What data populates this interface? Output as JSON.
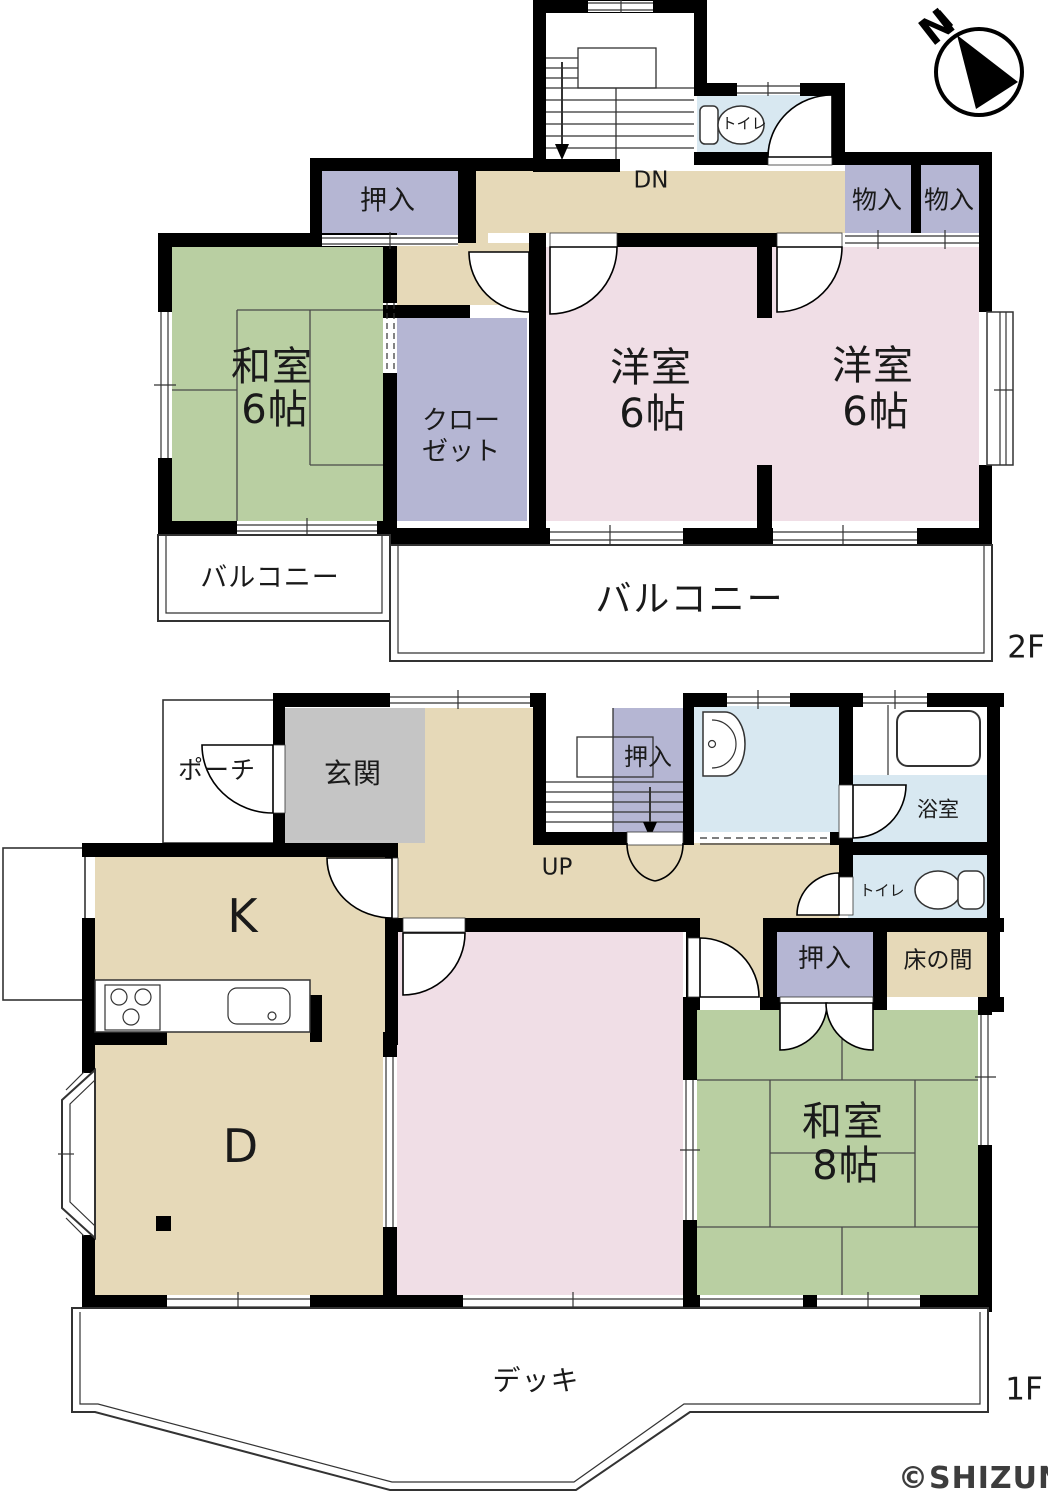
{
  "compass": {
    "north": "N"
  },
  "floor2": {
    "label": "2F",
    "stairs": "DN",
    "oshiire": "押入",
    "toilet": "トイレ",
    "mono1": "物入",
    "mono2": "物入",
    "washitsu_name": "和室",
    "washitsu_size": "6帖",
    "closet_line1": "クロー",
    "closet_line2": "ゼット",
    "yoshitsu1_name": "洋室",
    "yoshitsu1_size": "6帖",
    "yoshitsu2_name": "洋室",
    "yoshitsu2_size": "6帖",
    "balcony_small": "バルコニー",
    "balcony_large": "バルコニー"
  },
  "floor1": {
    "label": "1F",
    "stairs": "UP",
    "porch": "ポーチ",
    "genkan": "玄関",
    "stairs_oshiire": "押入",
    "bath": "浴室",
    "toilet": "トイレ",
    "oshiire": "押入",
    "tokonoma": "床の間",
    "kitchen": "K",
    "dining": "D",
    "washitsu_name": "和室",
    "washitsu_size": "8帖",
    "deck": "デッキ"
  },
  "watermark": "©SHIZUNAVI",
  "colors": {
    "tatami": "#b9cfa2",
    "western": "#f0dee6",
    "hall": "#e6d9b8",
    "closet": "#b5b6d3",
    "wet": "#d8e8f1",
    "genkan": "#c5c5c5",
    "wall": "#000000",
    "line": "#333333"
  }
}
